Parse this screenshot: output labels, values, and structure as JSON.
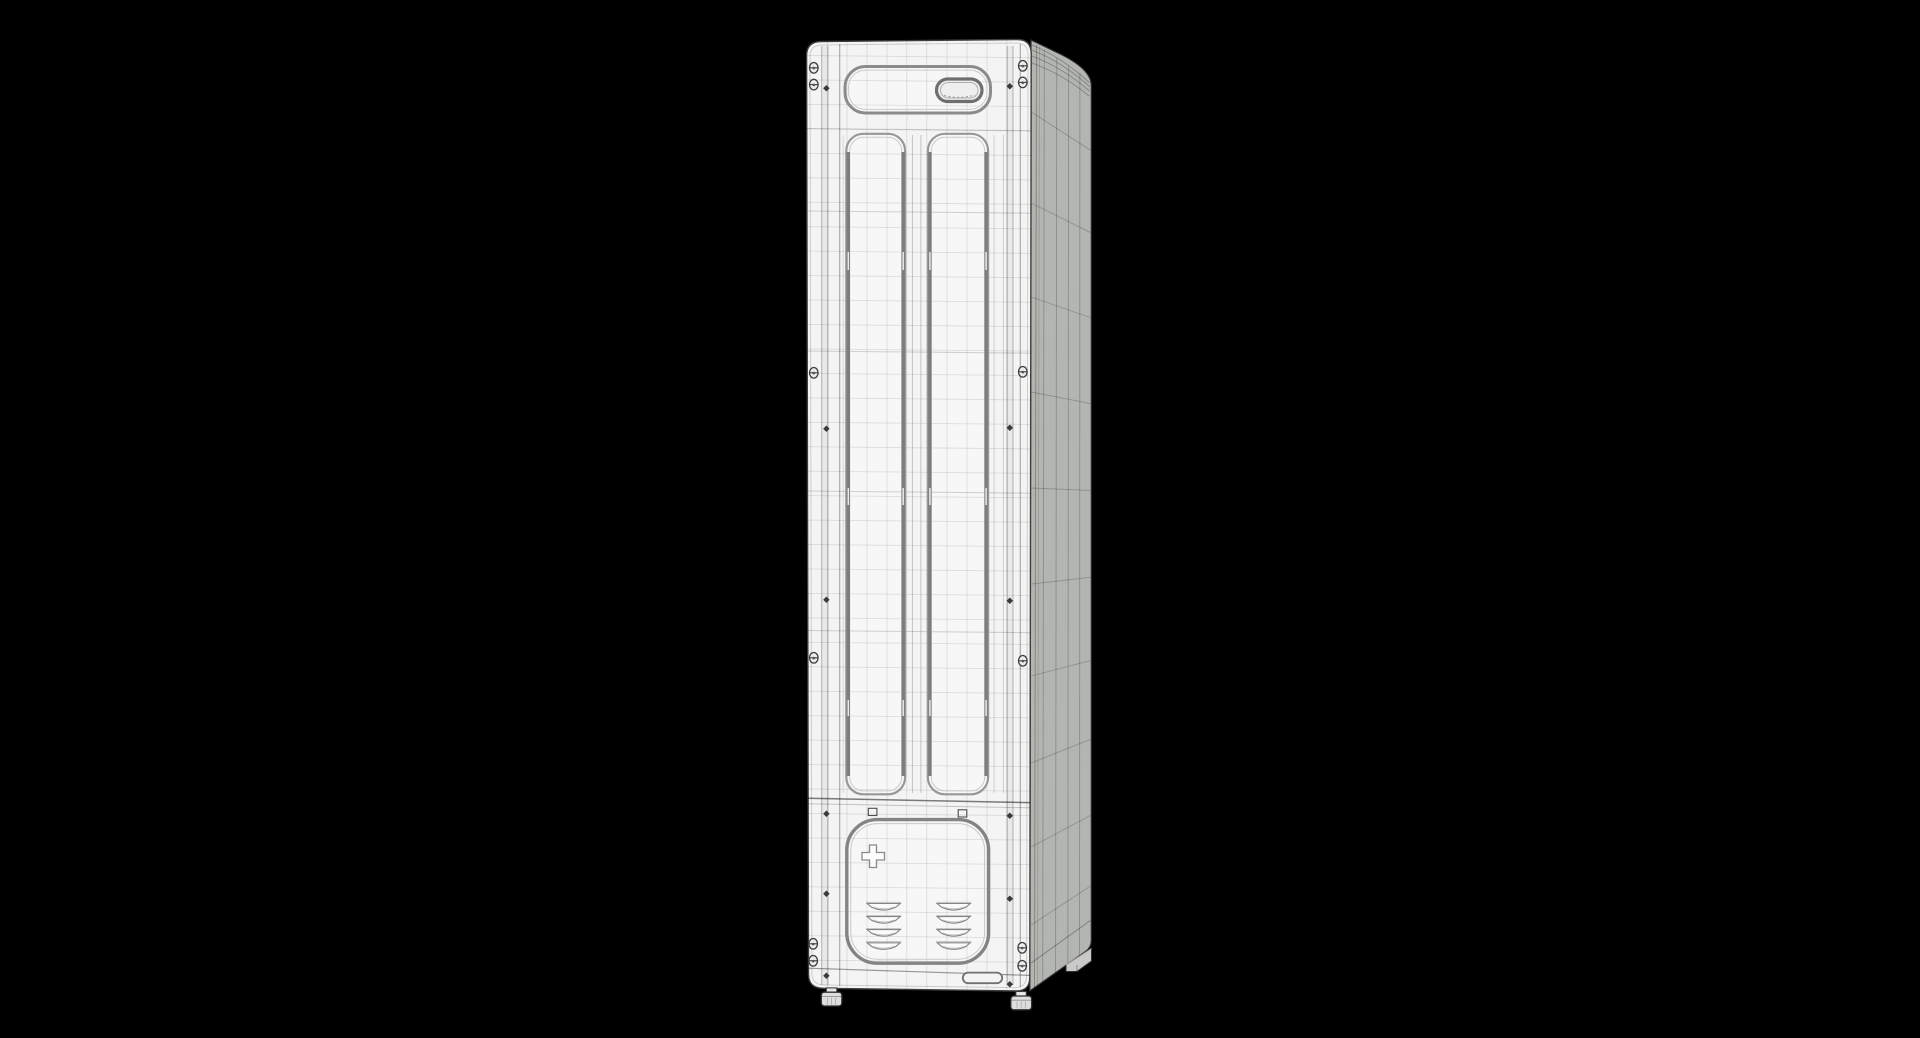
{
  "viewport": {
    "type": "3d-render",
    "object": "floor-standing cabinet, wireframe shaded render",
    "view": "three-quarter front-right",
    "background_color": "#000000"
  },
  "colors": {
    "background": "#000000",
    "front_face": "#f4f4f4",
    "panel_fill": "#f7f7f7",
    "side_face": "#b3b5b1",
    "outline": "#3d3d3d",
    "side_outline": "#2e2e2e",
    "panel_stroke": "#979797",
    "heavy_stroke": "#848484",
    "accent_stroke": "#7d7d7d",
    "detail_stroke": "#6f6f6f",
    "inner_line": "#cacaca",
    "louver_stroke": "#858585",
    "screw_fill": "#ededed",
    "screw_stroke": "#3d3d3d",
    "rivet_fill": "#3a3a3a",
    "foot_fill": "#dedede",
    "foot_stroke": "#303030",
    "rear_foot_fill": "#c9c9c9"
  },
  "model": {
    "door_panels": 2,
    "louver_columns": 2,
    "louver_rows": 4,
    "screws_left": 6,
    "screws_right": 6,
    "rivets_left": 6,
    "rivets_right": 6,
    "feet_visible": 3,
    "has_top_handle_recess": true,
    "has_bottom_access_panel": true,
    "has_plus_marker": true,
    "has_label_slot": true
  }
}
